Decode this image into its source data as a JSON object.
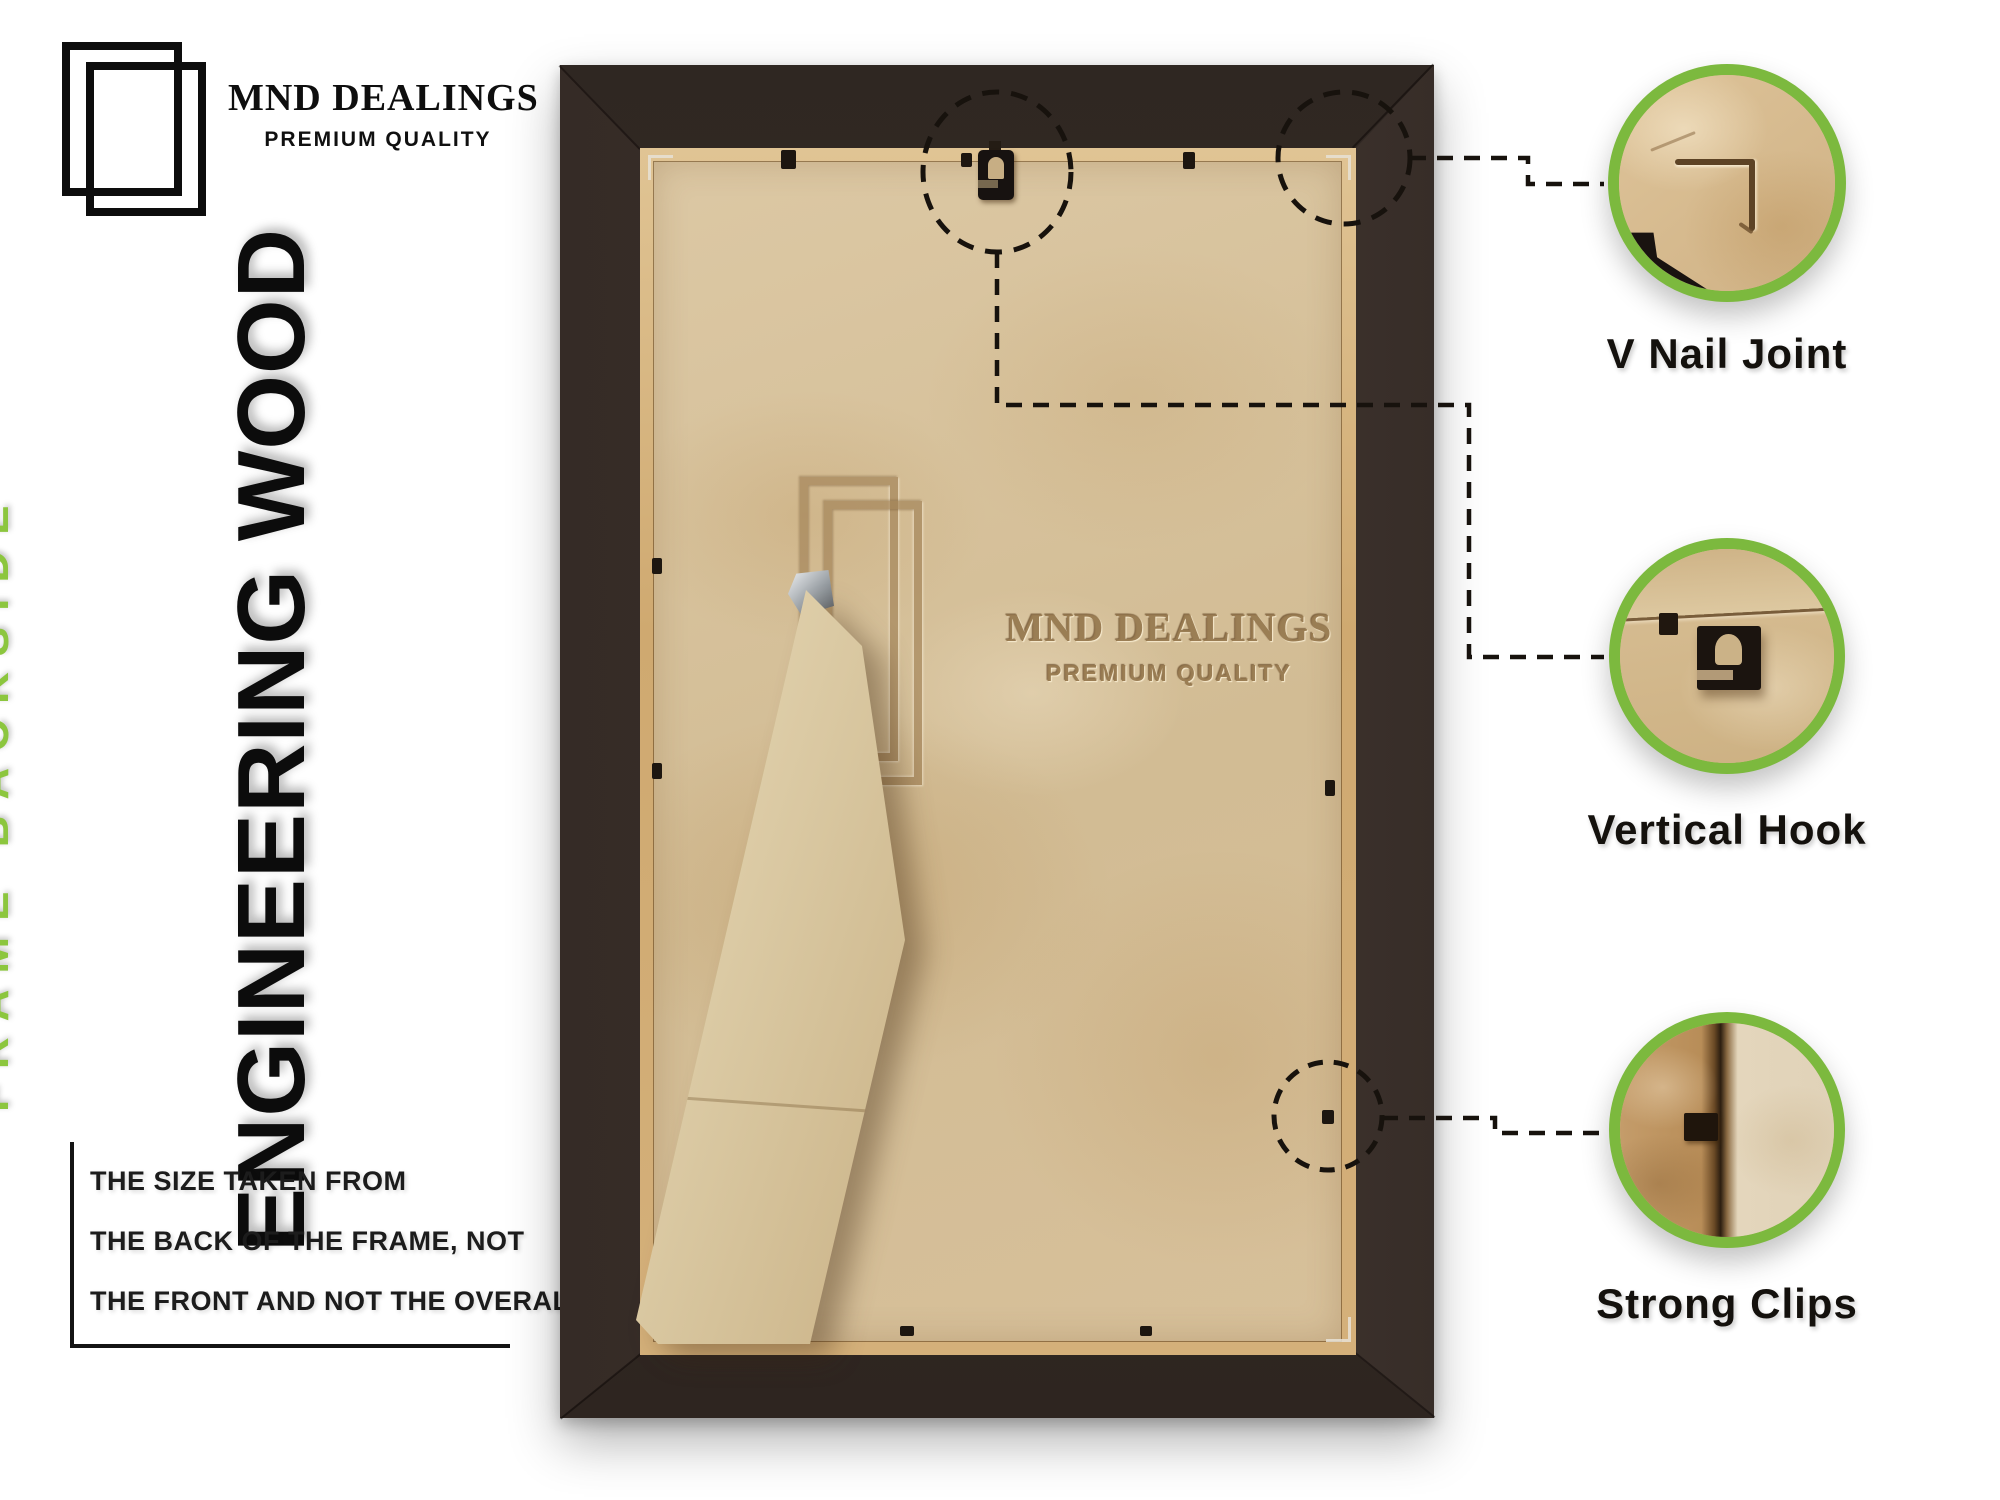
{
  "brand": {
    "name": "MND DEALINGS",
    "tagline": "PREMIUM QUALITY"
  },
  "left_panel": {
    "side_label": "FRAME BACKSIDE",
    "material_label": "ENGINEERING WOOD",
    "size_note": {
      "lines": [
        "THE SIZE TAKEN FROM",
        "THE BACK OF THE FRAME, NOT",
        "THE FRONT AND NOT THE OVERALL SIZE."
      ]
    }
  },
  "photo": {
    "emboss": {
      "name": "MND DEALINGS",
      "tagline": "PREMIUM QUALITY"
    }
  },
  "callouts": [
    {
      "label": "V Nail Joint"
    },
    {
      "label": "Vertical Hook"
    },
    {
      "label": "Strong Clips"
    }
  ],
  "colors": {
    "accent_green": "#7cb93e",
    "green_text": "#8cc63e",
    "label_text": "#14110d",
    "frame_wood": "#362c27",
    "backing_board": "#d6c19c"
  }
}
